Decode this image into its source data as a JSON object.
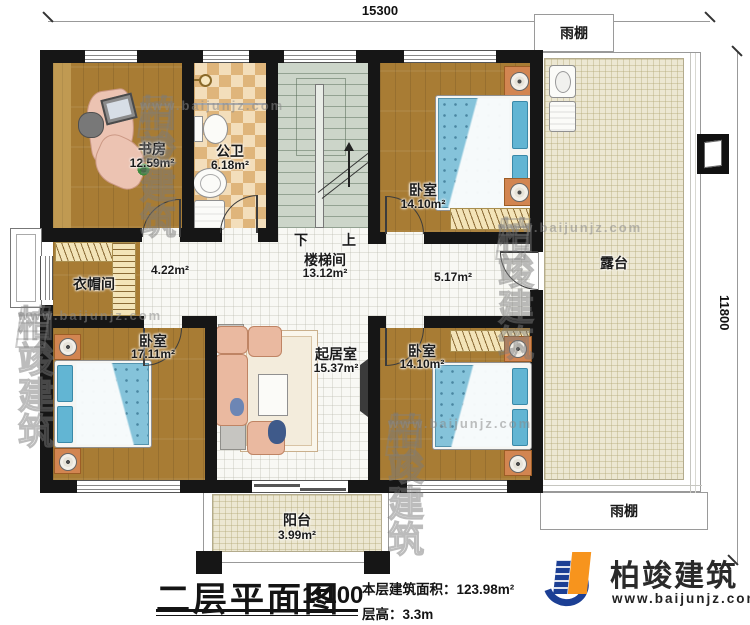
{
  "drawing": {
    "dimension_top": "15300",
    "dimension_right": "11800"
  },
  "canopy": {
    "top_label": "雨棚",
    "bottom_label": "雨棚"
  },
  "rooms": {
    "study": {
      "name": "书房",
      "area": "12.59m²"
    },
    "bathroom": {
      "name": "公卫",
      "area": "6.18m²"
    },
    "stairwell": {
      "name": "楼梯间",
      "area": "13.12m²",
      "down": "下",
      "up": "上"
    },
    "bedroom_top_right": {
      "name": "卧室",
      "area": "14.10m²"
    },
    "terrace": {
      "name": "露台"
    },
    "cloakroom": {
      "name": "衣帽间"
    },
    "hallway_left": {
      "area": "4.22m²"
    },
    "hallway_right": {
      "area": "5.17m²"
    },
    "bedroom_bottom_left": {
      "name": "卧室",
      "area": "17.11m²"
    },
    "living_room": {
      "name": "起居室",
      "area": "15.37m²"
    },
    "bedroom_bottom_right": {
      "name": "卧室",
      "area": "14.10m²"
    },
    "balcony": {
      "name": "阳台",
      "area": "3.99m²"
    }
  },
  "title_block": {
    "title": "二层平面图",
    "scale": "1:100",
    "area_note": "本层建筑面积：123.98m²",
    "height_note": "层高：3.3m"
  },
  "brand": {
    "name": "柏竣建筑",
    "website": "www.baijunjz.com",
    "blue": "#1c3f94",
    "orange": "#f7941d"
  },
  "watermark": {
    "name": "柏竣建筑",
    "website": "www.baijunjz.com"
  }
}
